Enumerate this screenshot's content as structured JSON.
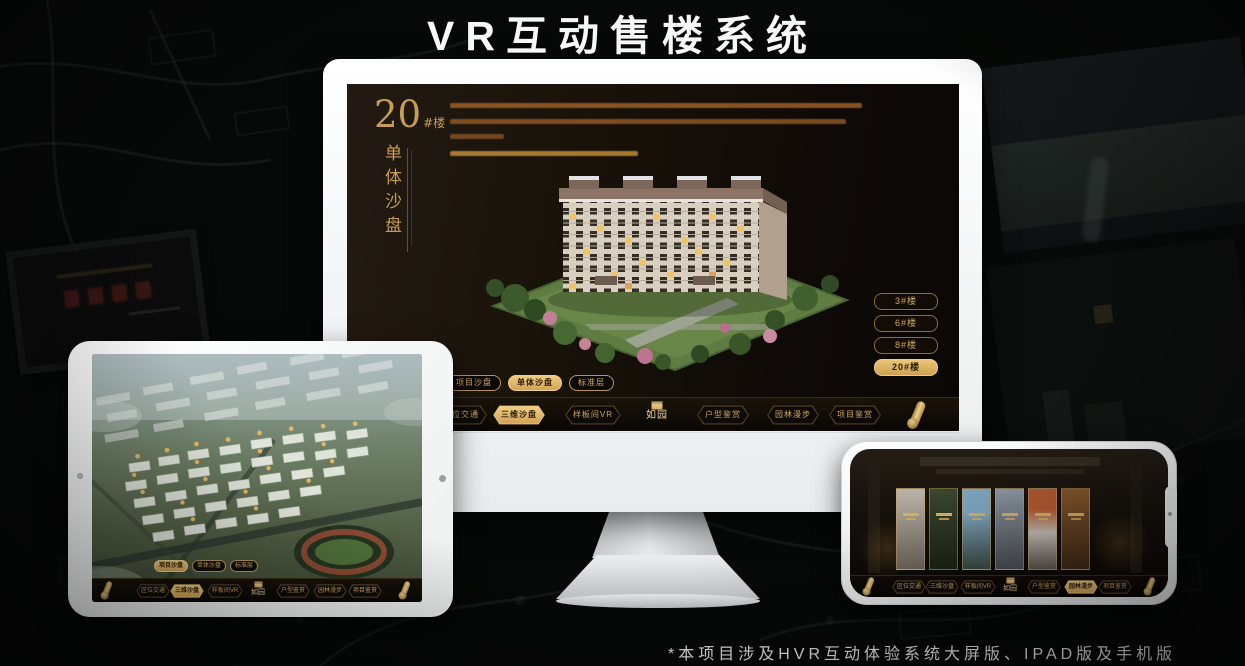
{
  "page": {
    "title": "VR互动售楼系统",
    "footnote": "*本项目涉及HVR互动体验系统大屏版、IPAD版及手机版"
  },
  "colors": {
    "gold": "#d2a65a",
    "gold_active": "#e9c678",
    "screen_background": "#15100c",
    "title_white": "#f7f7f7"
  },
  "icons": {
    "scroll": "gold rolled-scroll handle",
    "seal": "gold square brand seal above logo text"
  },
  "monitor": {
    "heading": {
      "number": "20",
      "suffix": "#楼",
      "subtitle": "单体沙盘"
    },
    "building_buttons": [
      {
        "label": "3#楼",
        "active": false
      },
      {
        "label": "6#楼",
        "active": false
      },
      {
        "label": "8#楼",
        "active": false
      },
      {
        "label": "20#楼",
        "active": true
      }
    ],
    "subtabs": [
      {
        "label": "项目沙盘",
        "active": false
      },
      {
        "label": "单体沙盘",
        "active": true
      },
      {
        "label": "标准层",
        "active": false
      }
    ],
    "nav": {
      "logo": "如园",
      "items": [
        {
          "label": "区位交通",
          "active": false
        },
        {
          "label": "三维沙盘",
          "active": true
        },
        {
          "label": "样板间VR",
          "active": false
        },
        {
          "label": "户型鉴赏",
          "active": false
        },
        {
          "label": "园林漫步",
          "active": false
        },
        {
          "label": "项目鉴赏",
          "active": false
        }
      ]
    }
  },
  "tablet": {
    "subtabs": [
      {
        "label": "项目沙盘",
        "active": true
      },
      {
        "label": "单体沙盘",
        "active": false
      },
      {
        "label": "标准层",
        "active": false
      }
    ],
    "nav": {
      "logo": "如园",
      "items": [
        {
          "label": "区位交通",
          "active": false
        },
        {
          "label": "三维沙盘",
          "active": true
        },
        {
          "label": "样板间VR",
          "active": false
        },
        {
          "label": "户型鉴赏",
          "active": false
        },
        {
          "label": "园林漫步",
          "active": false
        },
        {
          "label": "项目鉴赏",
          "active": false
        }
      ]
    }
  },
  "phone": {
    "gallery_card_count": 6,
    "nav": {
      "logo": "如园",
      "items": [
        {
          "label": "区位交通",
          "active": false
        },
        {
          "label": "三维沙盘",
          "active": false
        },
        {
          "label": "样板间VR",
          "active": false
        },
        {
          "label": "户型鉴赏",
          "active": false
        },
        {
          "label": "园林漫步",
          "active": true
        },
        {
          "label": "项目鉴赏",
          "active": false
        }
      ]
    }
  }
}
